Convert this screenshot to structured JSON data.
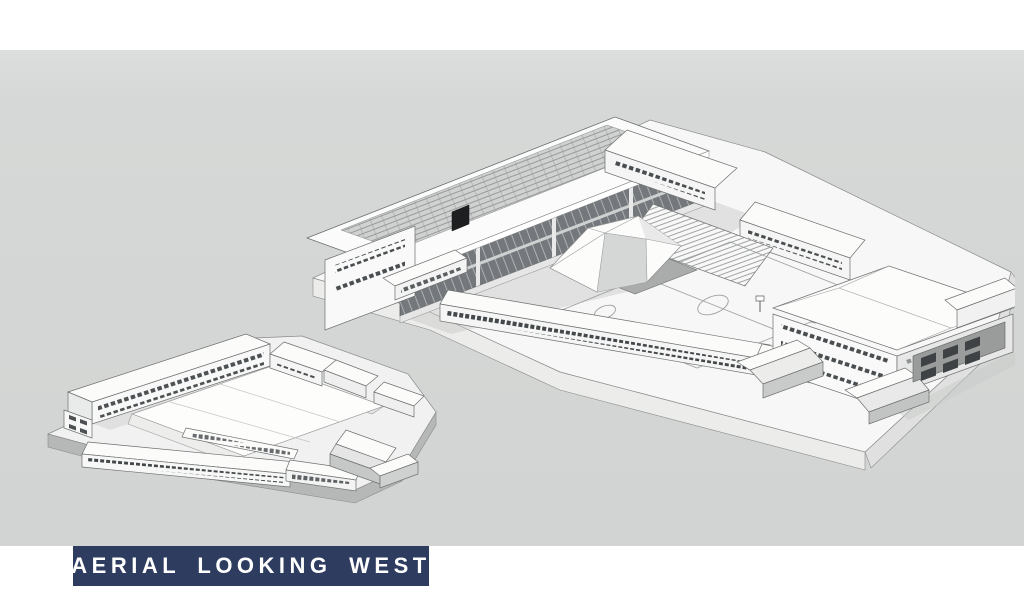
{
  "slide": {
    "canvas_color": "#d6d8d7",
    "margin_color": "#ffffff"
  },
  "labels": {
    "existing": "Existing",
    "proposed": "Proposed",
    "label_color": "#ffffff"
  },
  "title_banner": {
    "text": "AERIAL LOOKING WEST",
    "background": "#2d3c5f",
    "text_color": "#ffffff"
  },
  "drawing_style": {
    "line_color": "#6d706f",
    "surface_white": "#fbfbfa",
    "shade_light": "#e7e8e7",
    "shade_mid": "#c2c4c3",
    "shade_dark": "#a8aaa9",
    "glazing_dark": "#70757a",
    "solar_panel": "#d0d2d1"
  }
}
